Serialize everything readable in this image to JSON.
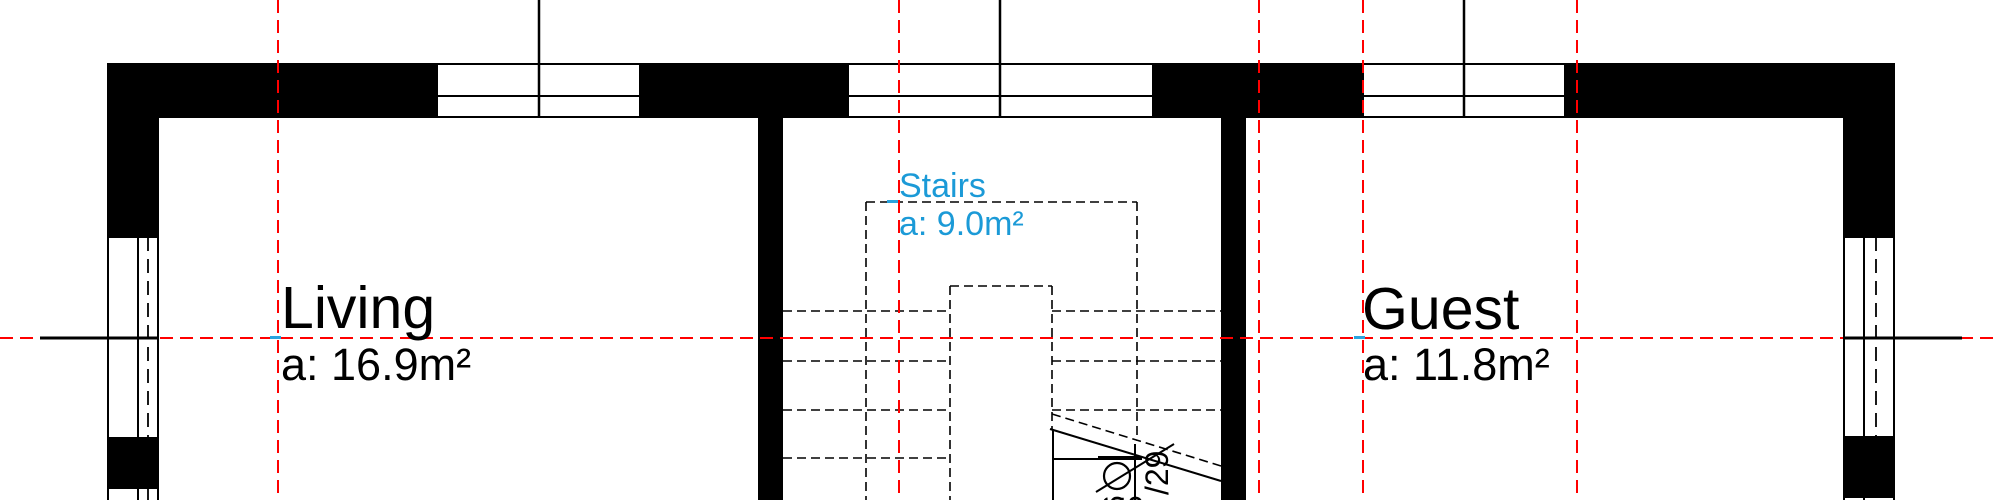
{
  "plan": {
    "title": "floor-plan-view",
    "rooms": [
      {
        "name": "Living",
        "area": "a: 16.9m²",
        "label_color": "#000000"
      },
      {
        "name": "Stairs",
        "area": "a: 9.0m²",
        "label_color": "#1b9ad7"
      },
      {
        "name": "Guest",
        "area": "a: 11.8m²",
        "label_color": "#000000"
      }
    ],
    "stairs_annotation": {
      "tread_text": "/29",
      "partial_text_1": "6",
      "partial_text_2": "5",
      "symbol": "walkline-start-circle"
    },
    "colors": {
      "wall_black": "#000000",
      "guide_red": "#ff0000",
      "room_label_blue": "#1b9ad7",
      "anchor_cyan": "#2aa4de"
    }
  }
}
